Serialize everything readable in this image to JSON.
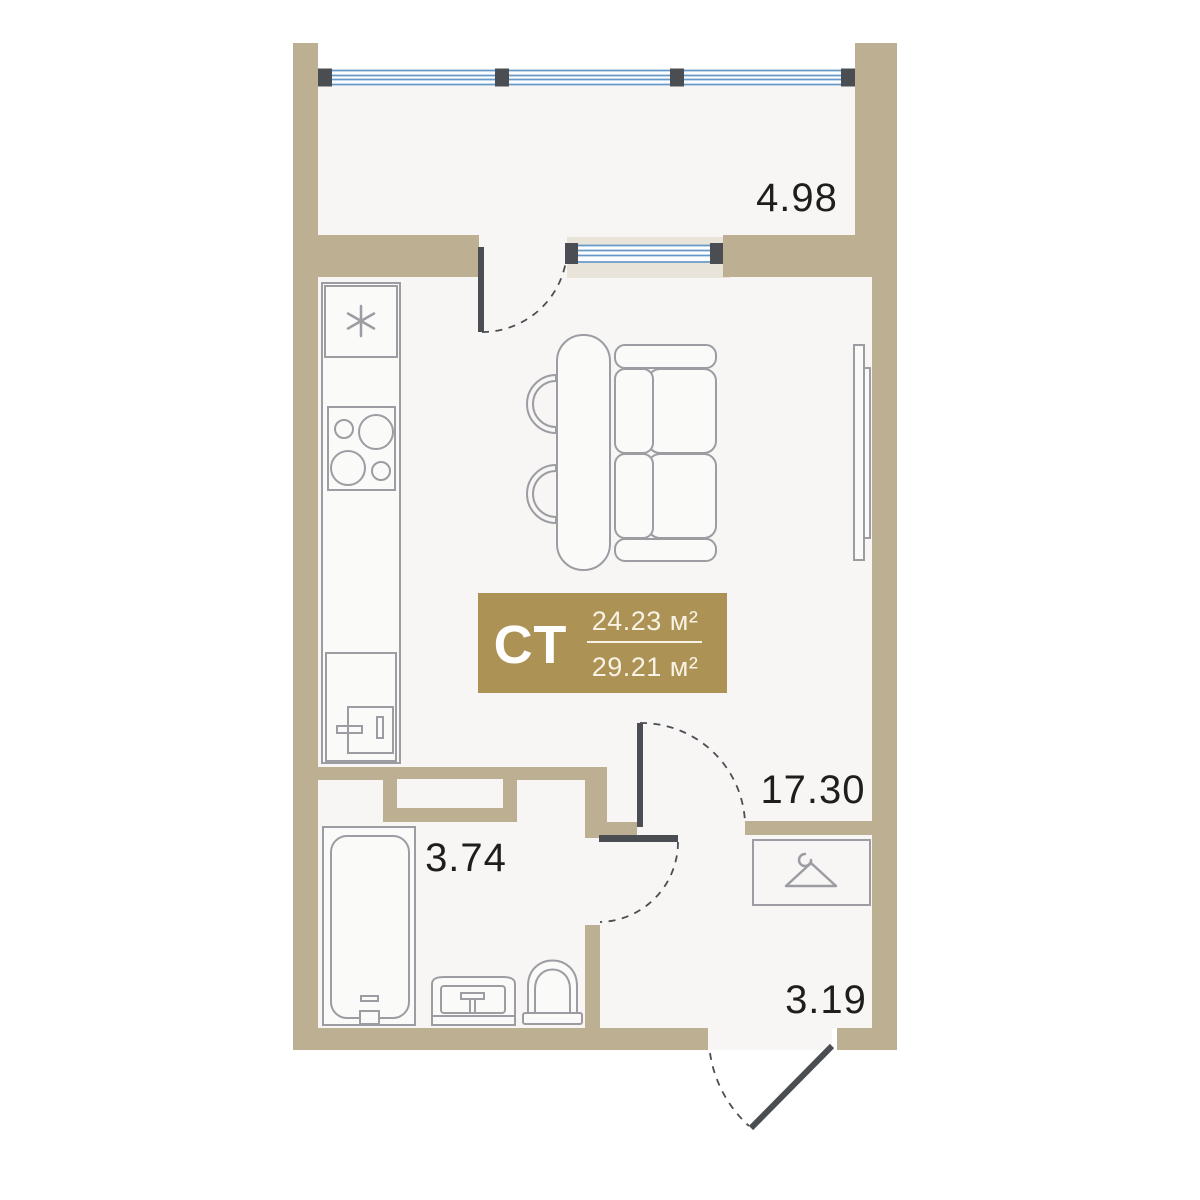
{
  "unit_card": {
    "type_label": "СТ",
    "area_upper": "24.23 м²",
    "area_lower": "29.21 м²"
  },
  "room_areas": {
    "balcony": "4.98",
    "living_room": "17.30",
    "bathroom": "3.74",
    "hallway": "3.19"
  },
  "colors": {
    "wall": "#bdb092",
    "wall_light": "#e9e4da",
    "floor": "#f7f6f5",
    "window_blue": "#6699c7",
    "door_dark": "#4a4e53",
    "furniture_gray": "#9c9ca2",
    "card_gold": "#ad9255",
    "card_text_cream": "#f7f2e3",
    "label_text": "#1e1e1c"
  },
  "icons": {
    "wardrobe": "hanger-icon",
    "fridge": "snowflake-icon"
  }
}
